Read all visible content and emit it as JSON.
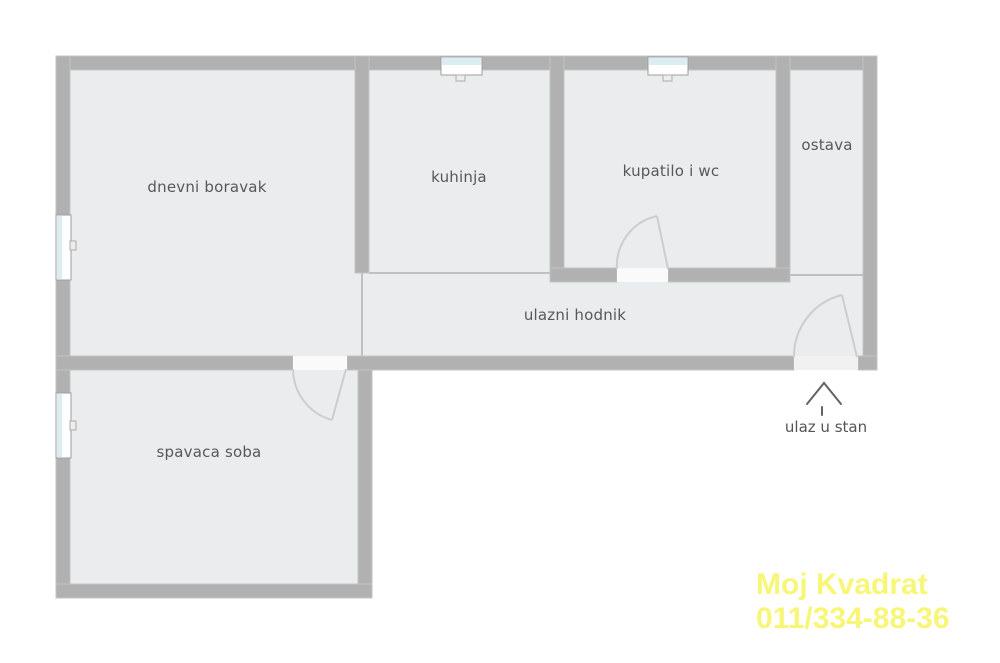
{
  "plan": {
    "rooms": [
      {
        "name": "dnevni boravak"
      },
      {
        "name": "kuhinja"
      },
      {
        "name": "kupatilo i wc"
      },
      {
        "name": "ostava"
      },
      {
        "name": "ulazni hodnik"
      },
      {
        "name": "spavaca soba"
      }
    ],
    "entrance": {
      "label": "ulaz u stan"
    },
    "colors": {
      "wall": "#b1b1b1",
      "wall_edge": "#c3c3c3",
      "floor": "#ebeced",
      "opening": "#fafafa",
      "entrance_opening": "#f1f1f1",
      "window_frame": "#9e9e9e",
      "window_glass": "#dcedf2",
      "door_arc": "#cdcdcd",
      "arrow": "#636363",
      "label_text": "#585858",
      "watermark": "#f8f677"
    }
  },
  "watermark": {
    "line1": "Moj Kvadrat",
    "line2": "011/334-88-36"
  }
}
